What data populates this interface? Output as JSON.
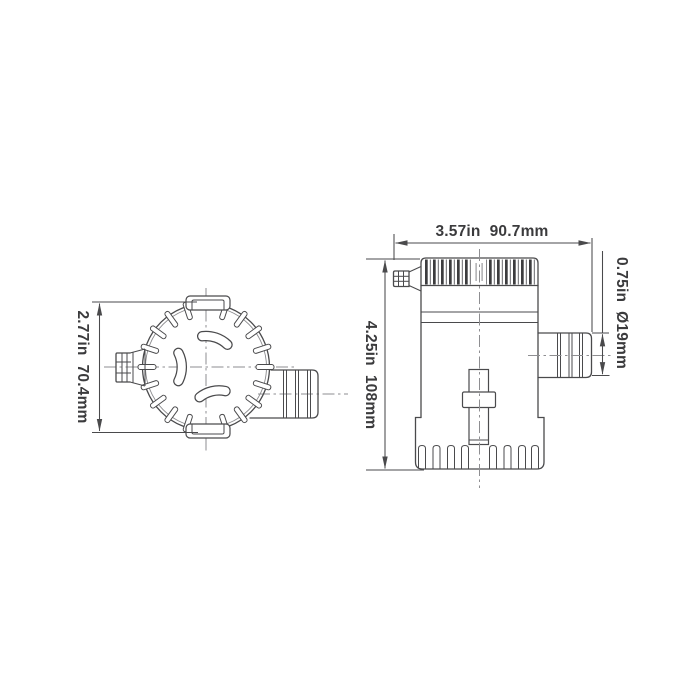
{
  "colors": {
    "background": "#ffffff",
    "line": "#4a4a4c",
    "centerline": "#8e8e91",
    "text": "#3b3b3d"
  },
  "dimensions": {
    "top_width": {
      "inches": "3.57in",
      "metric": "90.7mm"
    },
    "left_height": {
      "inches": "2.77in",
      "metric": "70.4mm"
    },
    "body_height": {
      "inches": "4.25in",
      "metric": "108mm"
    },
    "outlet_diameter": {
      "inches": "0.75in",
      "metric": "Ø19mm"
    }
  }
}
